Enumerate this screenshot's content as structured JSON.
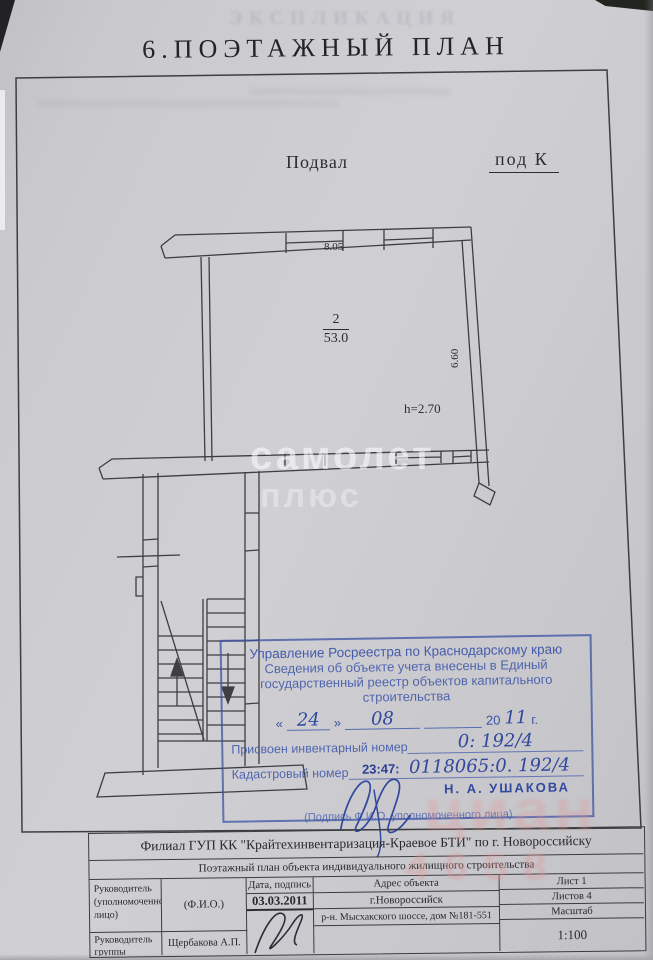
{
  "page": {
    "ghost_header": "ЭКСПЛИКАЦИЯ",
    "title": "6.ПОЭТАЖНЫЙ  ПЛАН"
  },
  "plan": {
    "floor_label": "Подвал",
    "liter_label": "под К",
    "dim_top": "8.05",
    "dim_right": "6.60",
    "room_number": "2",
    "room_area": "53.0",
    "height_note": "h=2.70"
  },
  "watermarks": {
    "samolet_line1": "самолет",
    "samolet_line2": "плюс",
    "pink_text": "циан",
    "pink_digits": "4658"
  },
  "stamp": {
    "line1": "Управление Росреестра по Краснодарскому краю",
    "line2": "Сведения об объекте учета внесены в Единый",
    "line3": "государственный реестр объектов капитального",
    "line4": "строительства",
    "date": {
      "open": "«",
      "day": "24",
      "close": "»",
      "month": "08",
      "year_printed": "20",
      "year_hand": "11",
      "year_suffix": "г."
    },
    "inventory_label": "Присвоен инвентарный номер",
    "inventory_value": "0: 192/4",
    "cadastral_label": "Кадастровый номер",
    "cadastral_prefix": "23:47:",
    "cadastral_value": "0118065:0. 192/4",
    "officer_name": "Н. А. УШАКОВА",
    "caption": "(Подпись Ф.И.О. уполномоченного лица)"
  },
  "footer_table": {
    "org_title": "Филиал ГУП КК \"Крайтехинвентаризация-Краевое БТИ\" по г. Новороссийску",
    "doc_title": "Поэтажный план объекта индивидуального жилищного  строительства",
    "role1": "Руководитель (уполномоченное лицо)",
    "role2": "Руководитель группы",
    "fio_header": "(Ф.И.О.)",
    "fio_value": "Щербакова А.П.",
    "date_header": "Дата, подпись",
    "date_value": "03.03.2011",
    "address_header": "Адрес объекта",
    "address_city": "г.Новороссийск",
    "address_street": "р-н. Мысхакского шоссе, дом №181-551",
    "sheet": "Лист 1",
    "sheets_total": "Листов 4",
    "scale_label": "Масштаб",
    "scale_value": "1:100"
  }
}
